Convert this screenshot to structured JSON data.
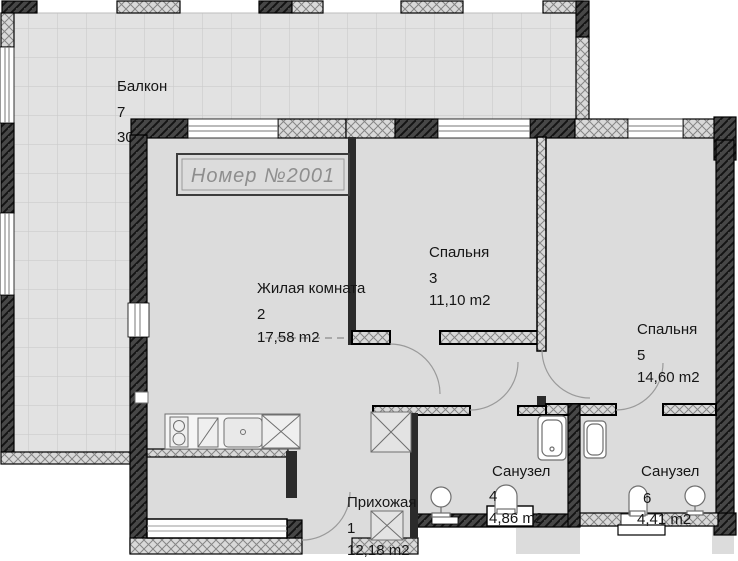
{
  "title": "Номер №2001",
  "rooms": [
    {
      "id": "hallway",
      "label": "Прихожая",
      "number": "1",
      "area": "12,18 m2"
    },
    {
      "id": "living-room",
      "label": "Жилая комната",
      "number": "2",
      "area": "17,58 m2"
    },
    {
      "id": "bedroom-3",
      "label": "Спальня",
      "number": "3",
      "area": "11,10 m2"
    },
    {
      "id": "bathroom-4",
      "label": "Санузел",
      "number": "4",
      "area": "4,86 m2"
    },
    {
      "id": "bedroom-5",
      "label": "Спальня",
      "number": "5",
      "area": "14,60 m2"
    },
    {
      "id": "bathroom-6",
      "label": "Санузел",
      "number": "6",
      "area": "4,41 m2"
    },
    {
      "id": "balcony",
      "label": "Балкон",
      "number": "7",
      "area": "30,01 m2"
    }
  ],
  "colors": {
    "apartment_floor": "#dcdcdc",
    "balcony_floor": "#e2e2e2",
    "wall_dark": "#474747",
    "wall_light": "#d9d9d9",
    "label_text": "#161616",
    "title_text": "#8e8e8e"
  }
}
